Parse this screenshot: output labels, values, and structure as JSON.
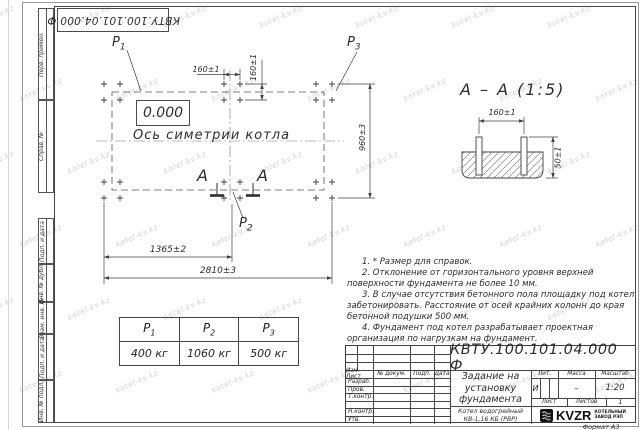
{
  "watermark": {
    "text": "kotel-kv.kz"
  },
  "colors": {
    "line": "#3f3f3f",
    "frame": "#454545",
    "watermark": "#d2d2d2"
  },
  "stamp": {
    "doc_number": "КВТУ.100.101.04.000  Ф"
  },
  "margin_strips": [
    {
      "label": "Перв. примен."
    },
    {
      "label": "Справ. №"
    },
    {
      "label": "Подп. и дата"
    },
    {
      "label": "Инв. № дубл."
    },
    {
      "label": "Взам. инв. №"
    },
    {
      "label": "Подп. и дата"
    },
    {
      "label": "Инв. № подл."
    }
  ],
  "plan": {
    "elevation": "0.000",
    "axis_label": "Ось симетрии котла",
    "p_labels": [
      {
        "base": "P",
        "sub": "1"
      },
      {
        "base": "P",
        "sub": "2"
      },
      {
        "base": "P",
        "sub": "3"
      }
    ],
    "section_letter": "А",
    "dims": {
      "top_h": "160±1",
      "top_v": "160±1",
      "right_v": "960±3",
      "bottom_inner": "1365±2",
      "bottom_outer": "2810±3"
    }
  },
  "section_view": {
    "title": "А – А (1:5)",
    "dim_h": "160±1",
    "dim_v": "50±1"
  },
  "notes": [
    "1. * Размер для справок.",
    "2. Отклонение от горизонтального уровня верхней поверхности фундамента не более 10 мм.",
    "3. В случае отсутствия бетонного пола площадку под котел забетонировать. Расстояние от осей крайних колонн до края бетонной подушки 500 мм.",
    "4. Фундамент под котел разрабатывает проектная организация по нагрузкам на фундамент."
  ],
  "load_table": {
    "headers": [
      {
        "base": "P",
        "sub": "1"
      },
      {
        "base": "P",
        "sub": "2"
      },
      {
        "base": "P",
        "sub": "3"
      }
    ],
    "values": [
      "400 кг",
      "1060 кг",
      "500 кг"
    ]
  },
  "title_block": {
    "doc_number": "КВТУ.100.101.04.000  Ф",
    "title_lines": [
      "Задание на",
      "установку",
      "фундамента"
    ],
    "product_lines": [
      "Котел водогрейный",
      "КВ-1,16 КБ  (РВР)"
    ],
    "rev_headers": {
      "izm_list": "Изм. Лист",
      "n_dokum": "№ докум.",
      "podp": "Подп.",
      "data": "Дата"
    },
    "sign_rows": [
      "Разраб.",
      "Пров.",
      "Т.контр.",
      "",
      "Н.контр.",
      "Утв."
    ],
    "lit_label": "Лит.",
    "mass_label": "Масса",
    "scale_label": "Масштаб",
    "lit_value": "И",
    "mass_value": "–",
    "scale_value": "1:20",
    "sheet_label": "Лист",
    "sheets_label": "Листов",
    "sheets_value": "1",
    "logo_text": "KVZR",
    "logo_lines": [
      "КОТЕЛЬНЫЙ",
      "ЗАВОД РЭП"
    ]
  },
  "footer": {
    "format_label": "Формат А3"
  }
}
